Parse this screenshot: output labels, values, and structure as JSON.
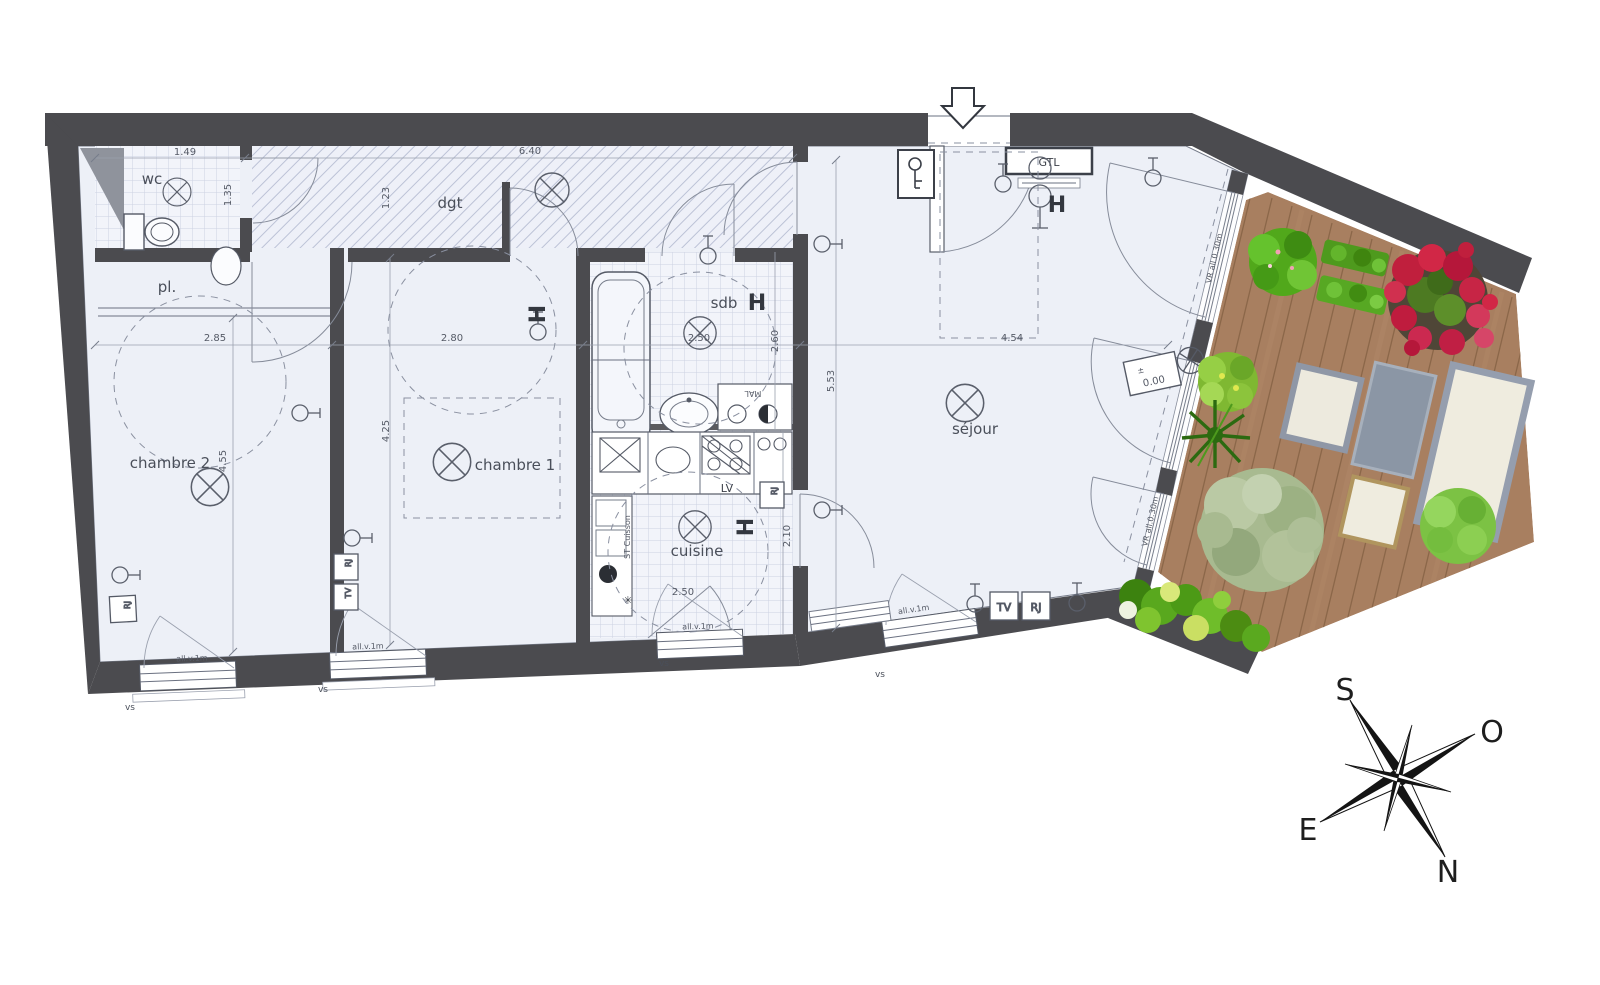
{
  "plan": {
    "rooms": {
      "chambre2": "chambre 2",
      "chambre1": "chambre 1",
      "wc": "wc",
      "pl": "pl.",
      "dgt": "dgt",
      "sdb": "sdb",
      "cuisine": "cuisine",
      "sejour": "séjour"
    },
    "dims": {
      "d149": "1.49",
      "d640": "6.40",
      "d123": "1.23",
      "d135": "1.35",
      "d285": "2.85",
      "d280": "2.80",
      "d250": "2.50",
      "d260": "2.60",
      "d455": "4.55",
      "d425": "4.25",
      "d210": "2.10",
      "d454": "4.54",
      "d553": "5.53"
    },
    "labels": {
      "gtl": "GTL",
      "h": "H",
      "lv": "LV",
      "tv": "TV",
      "rj": "RJ",
      "mal": "MAL",
      "st_cuisson": "ST Cuisson",
      "all_v": "all.v.1m",
      "vs": "vs",
      "vr": "VR all.0.30m",
      "level_pm": "±",
      "level": "0.00",
      "star": "✳"
    },
    "compass": {
      "s": "S",
      "o": "O",
      "e": "E",
      "n": "N"
    },
    "colors": {
      "wall": "#4b4b4f",
      "floor": "#edf0f7",
      "hatch": "#bcc2d6",
      "deck": "#a87f60",
      "plant_green": "#58a41f",
      "flower_red": "#c21f3e"
    }
  }
}
